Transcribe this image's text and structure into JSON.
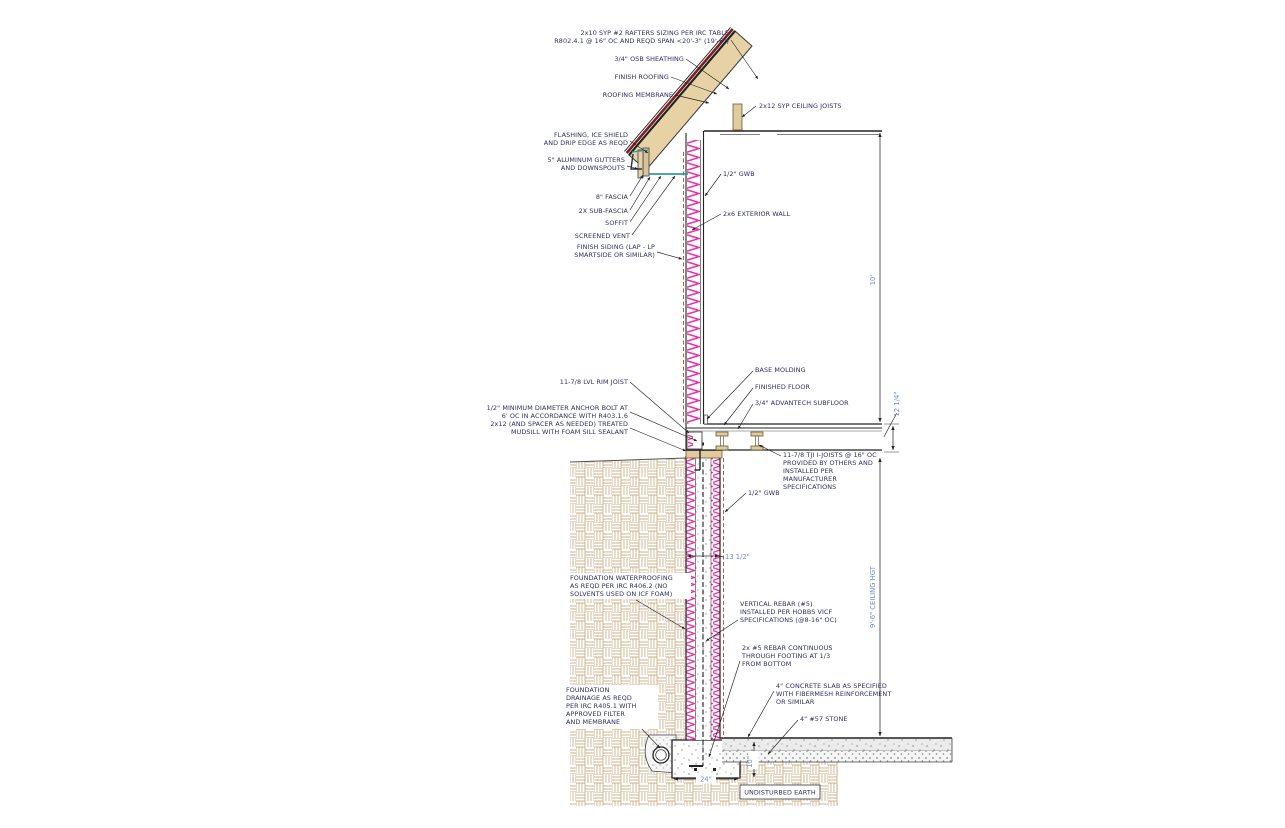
{
  "drawing": {
    "type": "architectural-wall-section-detail",
    "colors": {
      "insulation_pink": "#ee2fa0",
      "wood_tan": "#e0cb9e",
      "roofing_maroon": "#7c1f1f",
      "gutter_teal": "#2f9ba1",
      "dimension_blue": "#6d8ed2",
      "label_text": "#2d2d5e",
      "earth_hatch": "#cbb08a"
    },
    "labels": {
      "rafters": [
        "2x10 SYP #2 RAFTERS SIZING PER IRC TABLE",
        "R802.4.1 @ 16\" OC AND REQD SPAN <20'-3\" (19'-6\")"
      ],
      "sheathing": [
        "3/4\" OSB SHEATHING"
      ],
      "finish_roofing": [
        "FINISH ROOFING"
      ],
      "membrane": [
        "ROOFING MEMBRANE"
      ],
      "ceiling_joists": [
        "2x12 SYP CEILING JOISTS"
      ],
      "flashing": [
        "FLASHING, ICE SHIELD",
        "AND DRIP EDGE AS REQD"
      ],
      "gutters": [
        "5\" ALUMINUM GUTTERS",
        "AND DOWNSPOUTS"
      ],
      "fascia": [
        "8\" FASCIA"
      ],
      "subfascia": [
        "2X SUB-FASCIA"
      ],
      "soffit": [
        "SOFFIT"
      ],
      "vent": [
        "SCREENED VENT"
      ],
      "gwb_upper": [
        "1/2\" GWB"
      ],
      "ext_wall": [
        "2x6 EXTERIOR WALL"
      ],
      "siding": [
        "FINISH SIDING (LAP - LP",
        "SMARTSIDE OR SIMILAR)"
      ],
      "rim_joist": [
        "11-7/8 LVL RIM JOIST"
      ],
      "base_molding": [
        "BASE MOLDING"
      ],
      "finished_floor": [
        "FINISHED FLOOR"
      ],
      "subfloor": [
        "3/4\" ADVANTECH SUBFLOOR"
      ],
      "anchor_bolt": [
        "1/2\" MINIMUM DIAMETER ANCHOR BOLT AT",
        "6' OC IN ACCORDANCE WITH R403.1.6",
        "2x12 (AND SPACER AS NEEDED) TREATED",
        "MUDSILL WITH FOAM SILL SEALANT"
      ],
      "tji": [
        "11-7/8 TJI I-JOISTS @ 16\" OC",
        "PROVIDED BY OTHERS AND",
        "INSTALLED PER",
        "MANUFACTURER",
        "SPECIFICATIONS"
      ],
      "gwb_lower": [
        "1/2\" GWB"
      ],
      "waterproofing": [
        "FOUNDATION WATERPROOFING",
        "AS REQD PER IRC R406.2 (NO",
        "SOLVENTS USED ON ICF FOAM)"
      ],
      "vertical_rebar": [
        "VERTICAL REBAR (#5)",
        "INSTALLED PER HOBBS VICF",
        "SPECIFICATIONS (@8-16\" OC)"
      ],
      "footing_rebar": [
        "2x #5 REBAR CONTINUOUS",
        "THROUGH FOOTING AT 1/3",
        "FROM BOTTOM"
      ],
      "drainage": [
        "FOUNDATION",
        "DRAINAGE AS REQD",
        "PER IRC R405.1 WITH",
        "APPROVED FILTER",
        "AND MEMBRANE"
      ],
      "slab": [
        "4\" CONCRETE SLAB AS SPECIFIED",
        "WITH FIBERMESH REINFORCEMENT",
        "OR SIMILAR"
      ],
      "stone": [
        "4\" #57 STONE"
      ],
      "earth": [
        "UNDISTURBED EARTH"
      ]
    },
    "dimensions": {
      "wall_height": "10'",
      "floor_depth": "12 1/4\"",
      "ceiling_height": "9'-6\" CEILING HGT",
      "icf_width": "13 1/2\"",
      "footing_width": "24\"",
      "footing_depth": "10\""
    }
  }
}
